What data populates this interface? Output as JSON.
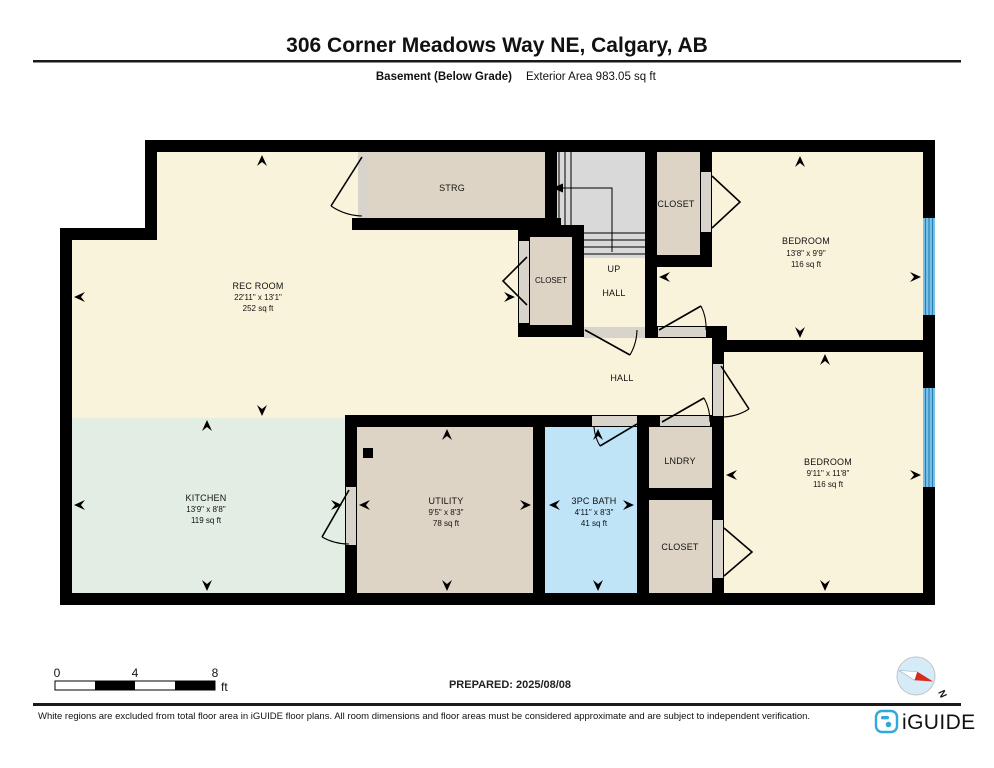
{
  "header": {
    "title": "306 Corner Meadows Way NE, Calgary, AB",
    "floor_label": "Basement (Below Grade)",
    "area_label": "Exterior Area 983.05 sq ft"
  },
  "rooms": {
    "rec": {
      "name": "REC ROOM",
      "dims": "22'11\" x 13'1\"",
      "area": "252 sq ft"
    },
    "strg": {
      "name": "STRG"
    },
    "closet_top": {
      "name": "CLOSET"
    },
    "closet_mid": {
      "name": "CLOSET"
    },
    "stairs": {
      "up": "UP",
      "hall": "HALL"
    },
    "bedroom_top": {
      "name": "BEDROOM",
      "dims": "13'8\" x 9'9\"",
      "area": "116 sq ft"
    },
    "hall": {
      "name": "HALL"
    },
    "kitchen": {
      "name": "KITCHEN",
      "dims": "13'9\" x 8'8\"",
      "area": "119 sq ft"
    },
    "utility": {
      "name": "UTILITY",
      "dims": "9'5\" x 8'3\"",
      "area": "78 sq ft"
    },
    "bath": {
      "name": "3PC BATH",
      "dims": "4'11\" x 8'3\"",
      "area": "41 sq ft"
    },
    "lndry": {
      "name": "LNDRY"
    },
    "closet_bottom": {
      "name": "CLOSET"
    },
    "bedroom_bottom": {
      "name": "BEDROOM",
      "dims": "9'11\" x 11'8\"",
      "area": "116 sq ft"
    }
  },
  "scale_bar": {
    "start": "0",
    "mid": "4",
    "end": "8",
    "unit": "ft"
  },
  "prepared_label": "PREPARED: 2025/08/08",
  "compass": {
    "north_label": "N"
  },
  "footer": {
    "disclaimer": "White regions are excluded from total floor area in iGUIDE floor plans. All room dimensions and floor areas must be considered approximate and are subject to independent verification.",
    "brand": "iGUIDE"
  },
  "colors": {
    "room_cream": "#faf3dc",
    "room_tan": "#ded4c6",
    "room_gray": "#d9d9d9",
    "room_mint": "#e2ede3",
    "room_blue": "#bfe3f7",
    "window_blue": "#79c2ec",
    "wall_black": "#000000",
    "brand_blue": "#2fa9dc",
    "compass_red": "#d92b1c",
    "compass_face": "#d6ebf8"
  }
}
